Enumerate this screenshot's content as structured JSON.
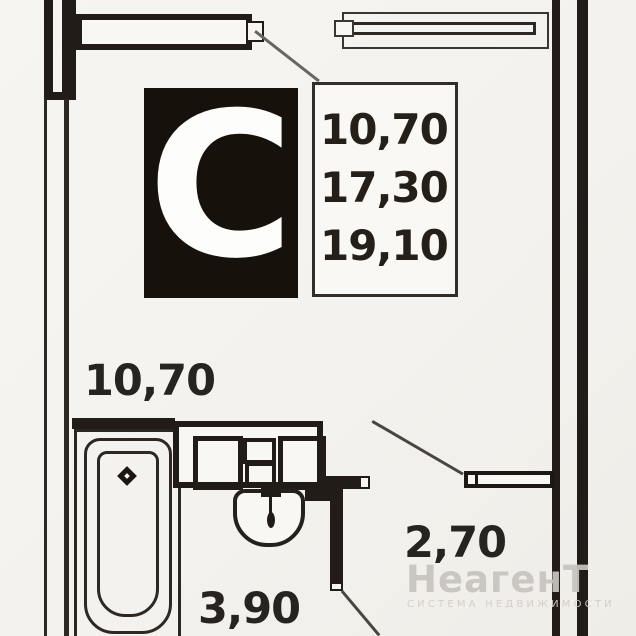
{
  "plan": {
    "unit_type_letter": "С",
    "info_box": {
      "values": [
        "10,70",
        "17,30",
        "19,10"
      ]
    },
    "room_labels": {
      "room": "10,70",
      "hall": "3,90",
      "entry": "2,70"
    },
    "watermark": {
      "brand": "НеагенТ",
      "tagline": "СИСТЕМА НЕДВИЖИМОСТИ"
    },
    "colors": {
      "wall": "#211c17",
      "background": "#f4f2ee",
      "unit_box_fill": "#17110b",
      "watermark": "#c7c3bf"
    }
  }
}
